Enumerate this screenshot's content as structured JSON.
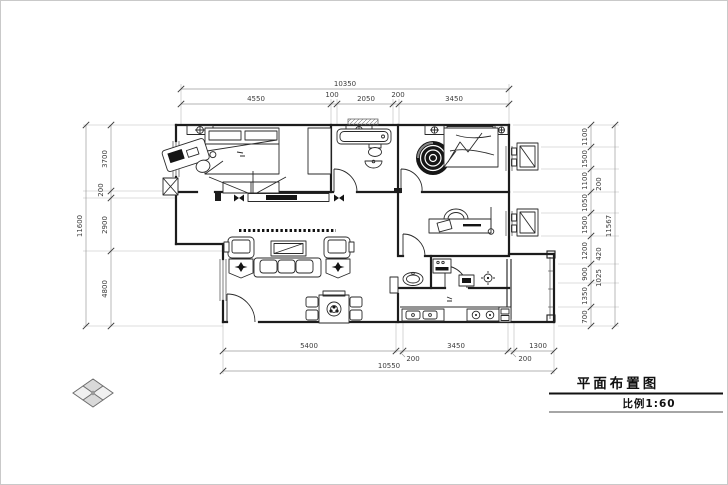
{
  "title_block": {
    "drawing_title": "平面布置图",
    "scale_label": "比例1:60"
  },
  "dimensions": {
    "top": {
      "overall": "10350",
      "segments": [
        "4550",
        "100",
        "2050",
        "200",
        "3450"
      ]
    },
    "bottom": {
      "overall": "10550",
      "segments": [
        "5400",
        "200",
        "3450",
        "200",
        "1300"
      ]
    },
    "left": {
      "overall": "11600",
      "segments": [
        "3700",
        "200",
        "2900",
        "4800"
      ]
    },
    "right": {
      "overall": "11567",
      "segments": [
        "1100",
        "1500",
        "1100",
        "1050",
        "1500",
        "1200",
        "900",
        "1350",
        "700"
      ],
      "sub_segments": [
        "200",
        "420",
        "1025"
      ]
    }
  },
  "icons": {
    "north_logo": "diamond-lattice-logo",
    "ac_unit": "air-conditioner-outdoor-unit",
    "ceiling_lamp": "wall-light-symbol"
  },
  "colors": {
    "wall": "#1c1c1c",
    "dimension_text": "#3c3c3c",
    "dimension_line": "#9a9a9a",
    "background": "#ffffff"
  }
}
